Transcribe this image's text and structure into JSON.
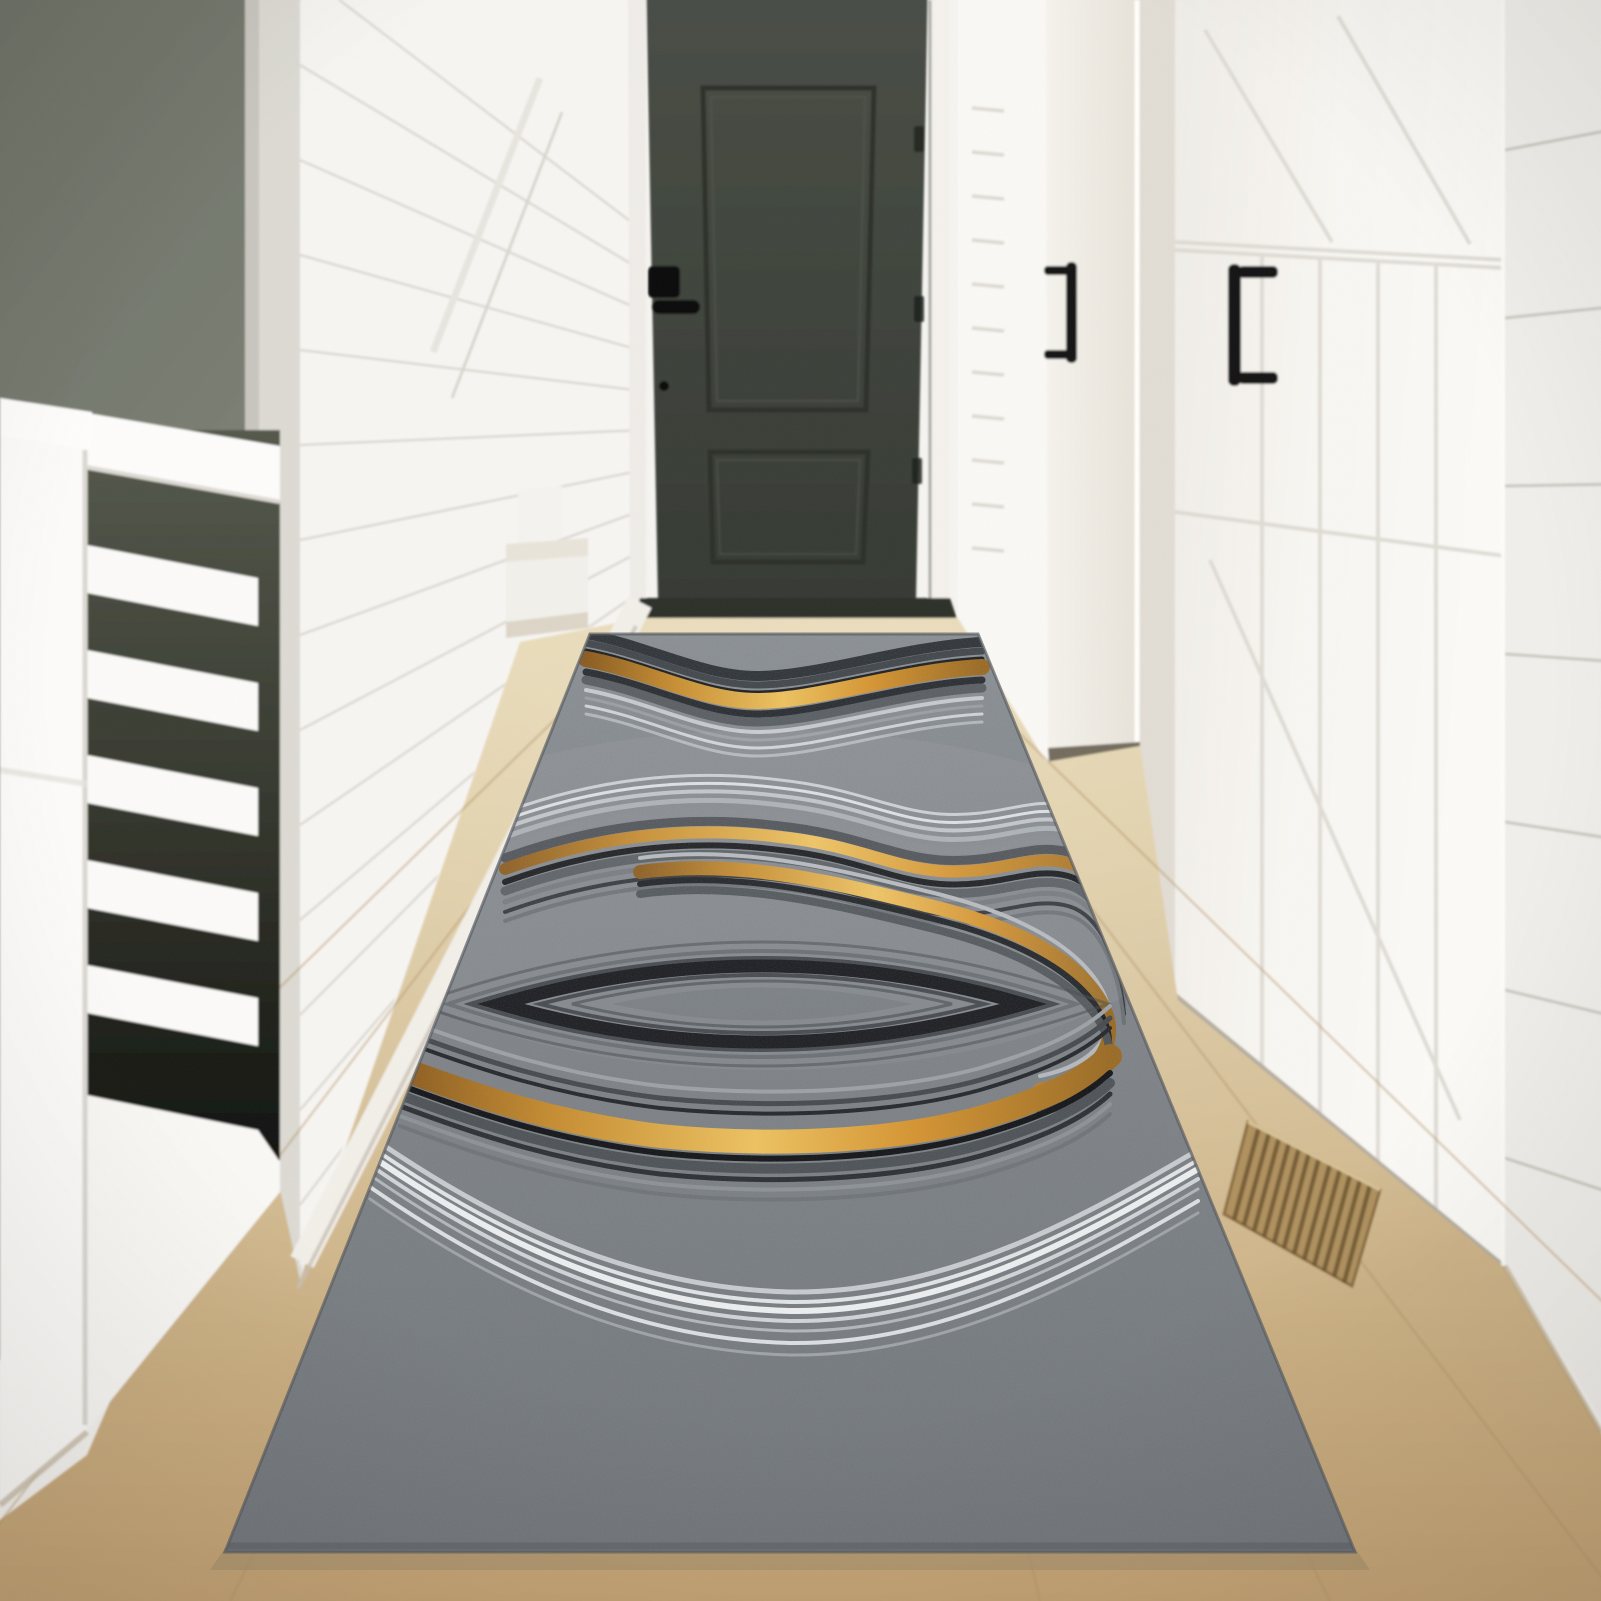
{
  "meta": {
    "description": "Product photo: a grey abstract runner rug with gold, black and white agate-style wave stripes and a central marquise eye motif, laid on a light wood floor in a white farmhouse hallway with a charcoal front door, two white barn doors and a white stair railing.",
    "alt": "Hallway runner rug product photograph"
  },
  "scene": {
    "setting": "bright farmhouse hallway, slightly blurred background, sharp rug in focus",
    "elements": [
      {
        "name": "dark-accent-wall",
        "position": "top left",
        "color": "#767a6e"
      },
      {
        "name": "stair-railing",
        "position": "left",
        "description": "white railing with horizontal slats, dark gaps between slats",
        "color": "#fbfaf8"
      },
      {
        "name": "left-shiplap-wall",
        "position": "center left",
        "description": "white horizontal shiplap planks with stair stringer diagonal",
        "color": "#f6f4f1"
      },
      {
        "name": "stair-steps",
        "position": "left of charcoal door",
        "color": "#f2f0ea"
      },
      {
        "name": "charcoal-door",
        "position": "center back",
        "description": "two-panel dark charcoal front door with black lever handle and hinges",
        "color": "#424740"
      },
      {
        "name": "end-wall",
        "position": "right of charcoal door",
        "color": "#faf8f4"
      },
      {
        "name": "middle-white-door",
        "position": "center right",
        "description": "white door with black pull handle",
        "color": "#f3f0ea"
      },
      {
        "name": "barn-door",
        "position": "right foreground",
        "description": "white plank barn door with diagonal braces and black pull handle",
        "color": "#f8f6f2"
      },
      {
        "name": "right-shiplap-wall",
        "position": "far right edge",
        "color": "#f2f0ec"
      },
      {
        "name": "wood-floor",
        "description": "light oak floor with perspective plank lines",
        "color": "#d3bd94"
      },
      {
        "name": "floor-vent",
        "position": "lower right on floor",
        "description": "brown slatted heat register",
        "color": "#8a6b42"
      }
    ]
  },
  "palette": {
    "accent_gold": "#d7952f",
    "rug_base_gray": "#7d8287",
    "rug_black": "#14161a",
    "rug_white": "#eef0f1",
    "wall_white": "#f6f4f1",
    "dark_wall_olive": "#767a6e",
    "door_charcoal": "#424740",
    "floor_wood": "#d3bd94",
    "hardware_black": "#151515",
    "vent_brown": "#8a6b42"
  },
  "rug": {
    "kind": "rectangular runner shown in strong perspective (trapezoid, wide toward viewer)",
    "base_color": "#7d8287",
    "texture": "mottled felted grey",
    "motif": "abstract agate layers with central marquise (eye) ring",
    "bands_far_to_near": [
      "dark grey wave band hugging the far edge with a metallic gold stripe inside and thin silver lines beneath",
      "plain mottled grey gap",
      "upper wave bundle: thin light-grey lines over dark stripes with a gold band, sweeping down the right side",
      "concentric marquise eye: thick black outline with thinner grey rings, plain grey core",
      "lower arc system: charcoal arcs with a wide bright gold band and a black line wrapping under the eye",
      "broad white and silver arc bundle sweeping across",
      "plain mottled grey field to the near edge"
    ],
    "stripe_colors": [
      "#14161a",
      "#32363a",
      "#585d62",
      "#868b90",
      "#b4b9bd",
      "#d2d5d8",
      "#eef0f1",
      "#d7952f"
    ]
  }
}
